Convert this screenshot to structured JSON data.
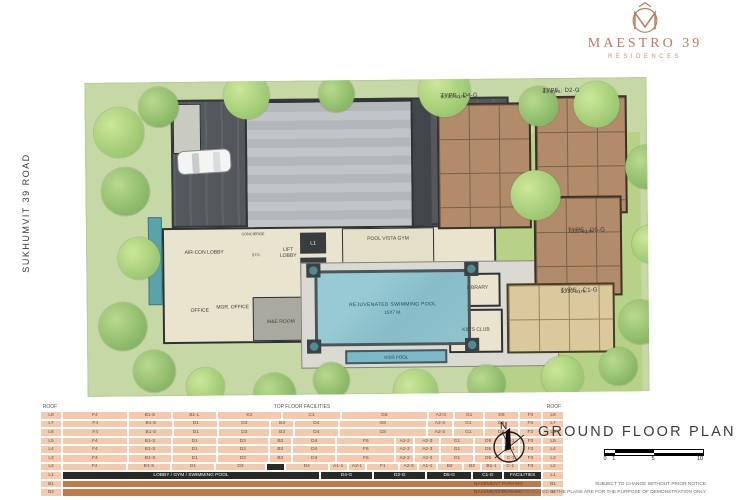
{
  "brand": {
    "name": "MAESTRO 39",
    "sub": "RESIDENCES",
    "color": "#bf7a5f"
  },
  "road": {
    "label": "SUKHUMVIT 39 ROAD"
  },
  "plan": {
    "labels": {
      "shuttle": "SHUTTLE SERVICE",
      "aircon": "AIR-CON LOBBY",
      "concierge": "CONCIERGE",
      "sto": "STO.",
      "lift_lobby": "LIFT LOBBY",
      "l1": "L1",
      "l2": "L2",
      "office": "OFFICE",
      "mgr_office": "MGR. OFFICE",
      "me_room": "M&E ROOM",
      "gym": "POOL VISTA GYM",
      "library": "LIBRARY",
      "kids_club": "KID'S CLUB",
      "pool_line1": "REJUVENATED SWIMMING POOL",
      "pool_line2": "15X7 M.",
      "kids_pool": "KIDS POOL"
    },
    "units": [
      {
        "type": "TYPE : D4-G",
        "area": "60.50 sq.m."
      },
      {
        "type": "TYPE : D2-G",
        "area": "63 sq.m."
      },
      {
        "type": "TYPE : D5-G",
        "area": "70.50 sq.m."
      },
      {
        "type": "TYPE : C1-G",
        "area": "50.50 sq.m."
      }
    ]
  },
  "table": {
    "header": {
      "left": "ROOF",
      "center": "TOP FLOOR FACILITIES",
      "right": "ROOF"
    },
    "colors": {
      "cell": "#f5c9ad",
      "black": "#2b2928",
      "basement": "#c17a49"
    },
    "rows": [
      {
        "floor": "L8",
        "cells": [
          [
            "F4",
            4.5
          ],
          [
            "B1-S",
            3
          ],
          [
            "B1-L",
            3
          ],
          [
            "K2",
            4.5
          ],
          [
            "C1",
            4
          ],
          [
            "G8",
            6
          ],
          [
            "A2-3",
            1.7
          ],
          [
            "G1",
            2
          ],
          [
            "D9",
            2.3
          ],
          [
            "F3",
            1.5
          ]
        ]
      },
      {
        "floor": "L7",
        "cells": [
          [
            "F4",
            4.5
          ],
          [
            "B1-S",
            3
          ],
          [
            "D1",
            3
          ],
          [
            "D3",
            3.5
          ],
          [
            "B3",
            1.5
          ],
          [
            "D4",
            3
          ],
          [
            "G8",
            6
          ],
          [
            "A2-3",
            1.7
          ],
          [
            "G1",
            2
          ],
          [
            "D9",
            2.3
          ],
          [
            "F3",
            1.5
          ]
        ]
      },
      {
        "floor": "L6",
        "cells": [
          [
            "F4",
            4.5
          ],
          [
            "B1-S",
            3
          ],
          [
            "D1",
            3
          ],
          [
            "D3",
            3.5
          ],
          [
            "B3",
            1.5
          ],
          [
            "D4",
            3
          ],
          [
            "G8",
            6
          ],
          [
            "A2-3",
            1.7
          ],
          [
            "G1",
            2
          ],
          [
            "D9",
            2.3
          ],
          [
            "F3",
            1.5
          ]
        ]
      },
      {
        "floor": "L5",
        "cells": [
          [
            "F4",
            4.5
          ],
          [
            "B1-S",
            3
          ],
          [
            "D1",
            3
          ],
          [
            "D3",
            3.5
          ],
          [
            "B3",
            1.5
          ],
          [
            "D4",
            3
          ],
          [
            "F6",
            4
          ],
          [
            "A2-2",
            1.2
          ],
          [
            "A2-3",
            1.7
          ],
          [
            "G1",
            2.2
          ],
          [
            "D5",
            1.9
          ],
          [
            "C-1",
            1
          ],
          [
            "F3",
            1.5
          ]
        ]
      },
      {
        "floor": "L4",
        "cells": [
          [
            "F4",
            4.5
          ],
          [
            "B1-S",
            3
          ],
          [
            "D1",
            3
          ],
          [
            "D3",
            3.5
          ],
          [
            "B3",
            1.5
          ],
          [
            "D4",
            3
          ],
          [
            "F6",
            4
          ],
          [
            "A2-2",
            1.2
          ],
          [
            "A2-3",
            1.7
          ],
          [
            "G1",
            2.2
          ],
          [
            "D5",
            1.9
          ],
          [
            "C-1",
            1
          ],
          [
            "F3",
            1.5
          ]
        ]
      },
      {
        "floor": "L3",
        "cells": [
          [
            "F4",
            4.5
          ],
          [
            "B1-S",
            3
          ],
          [
            "D1",
            3
          ],
          [
            "D3",
            3.5
          ],
          [
            "B3",
            1.5
          ],
          [
            "D4",
            3
          ],
          [
            "F6",
            4
          ],
          [
            "A2-2",
            1.2
          ],
          [
            "A2-3",
            1.7
          ],
          [
            "G1",
            2.2
          ],
          [
            "D5",
            1.9
          ],
          [
            "C-1",
            1
          ],
          [
            "F3",
            1.5
          ]
        ]
      },
      {
        "floor": "L2",
        "cells": [
          [
            "F4",
            4.5
          ],
          [
            "B1-S",
            3
          ],
          [
            "D1",
            3
          ],
          [
            "D3",
            3.5
          ],
          [
            "",
            1.2,
            "black"
          ],
          [
            "D4",
            3
          ],
          [
            "A1-1",
            1.2
          ],
          [
            "A2-1",
            1.2
          ],
          [
            "F1",
            2.2
          ],
          [
            "A2-3",
            1.2
          ],
          [
            "A1-1",
            1.2
          ],
          [
            "B2",
            1.7
          ],
          [
            "B2",
            1.2
          ],
          [
            "B1-1",
            1.3
          ],
          [
            "C-1",
            1.1
          ],
          [
            "F3",
            1.5
          ]
        ]
      },
      {
        "floor": "L1",
        "cells": [
          [
            "LOBBY / GYM / SWIMMING POOL",
            17.5,
            "black"
          ],
          [
            "D4-G",
            3.5,
            "black"
          ],
          [
            "D2-G",
            3.5,
            "black"
          ],
          [
            "D5-G",
            3,
            "black"
          ],
          [
            "C1-G",
            2,
            "black"
          ],
          [
            "FACILITIES",
            2.5,
            "black"
          ]
        ]
      },
      {
        "floor": "B1",
        "cells": [
          [
            "BASEMENT PARKING",
            32,
            "basement"
          ]
        ]
      },
      {
        "floor": "B2",
        "cells": [
          [
            "BASEMENT PARKING",
            32,
            "basement"
          ]
        ]
      }
    ]
  },
  "titleblock": {
    "north": "N",
    "title": "GROUND FLOOR PLAN",
    "scale_ticks": [
      "0",
      "1",
      "5",
      "10"
    ],
    "disclaimer1": "SUBJECT TO CHANGE WITHOUT PRIOR NOTICE",
    "disclaimer2": "THE FURNITURE INDICATED IN THE PLANS ARE FOR THE PURPOSE OF DEMONSTRATION ONLY"
  }
}
